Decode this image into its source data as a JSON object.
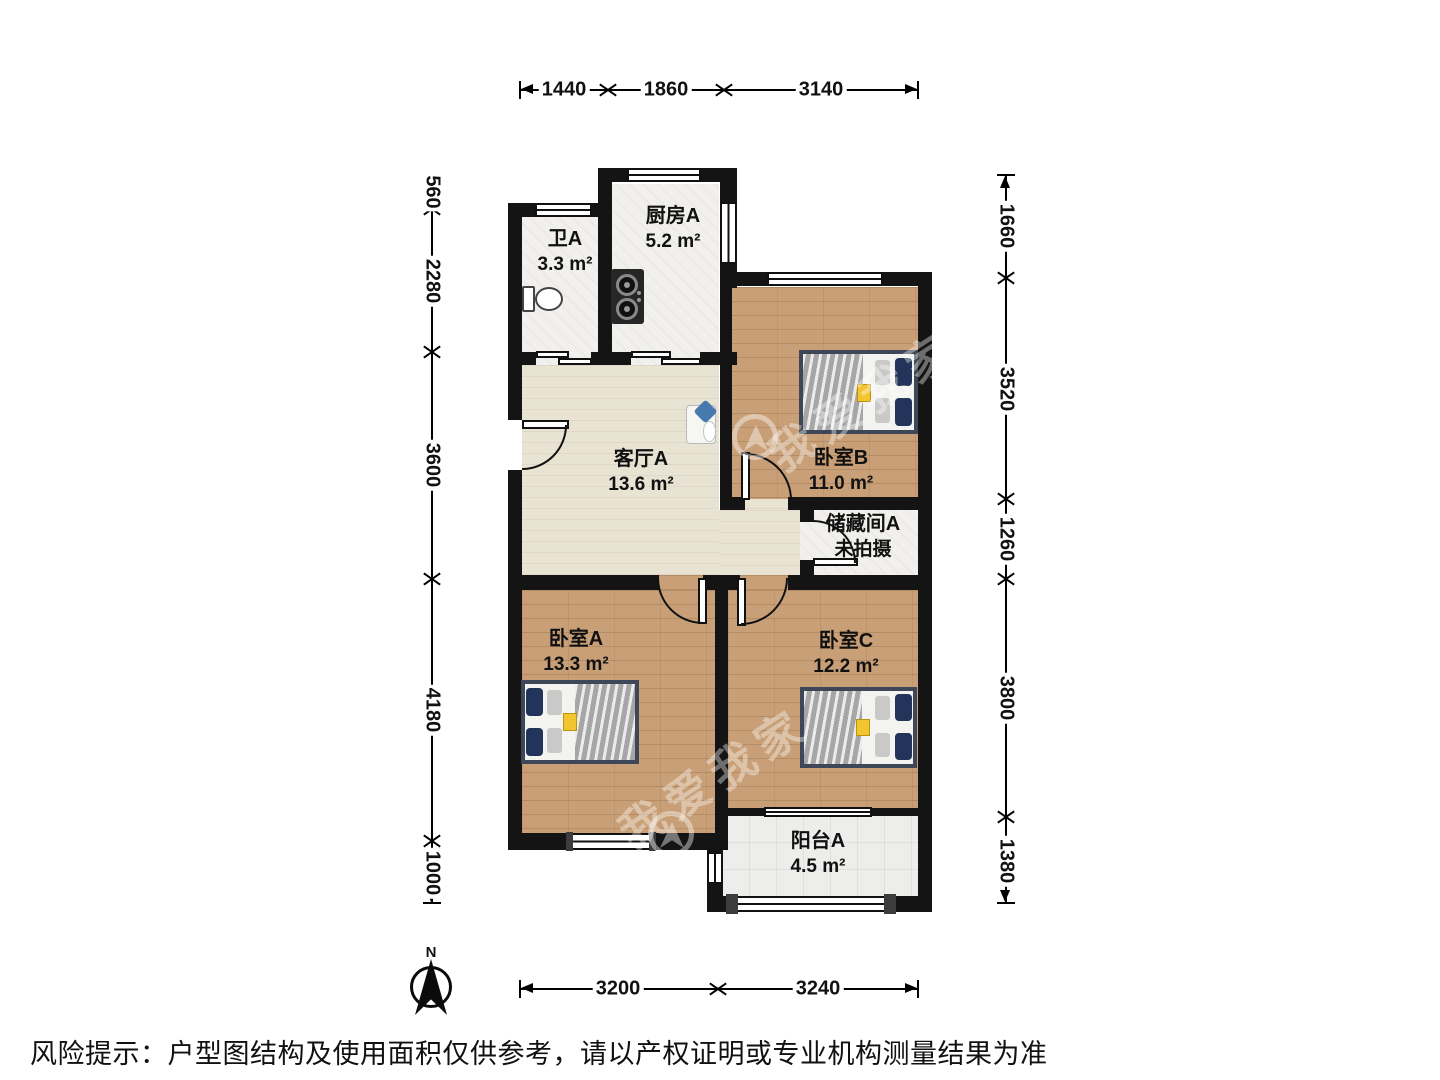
{
  "page": {
    "risk_notice": "风险提示：户型图结构及使用面积仅供参考，请以产权证明或专业机构测量结果为准"
  },
  "compass": {
    "label": "N"
  },
  "watermark": {
    "text": "我爱我家"
  },
  "dimensions": {
    "top": [
      "1440",
      "1860",
      "3140"
    ],
    "bottom": [
      "3200",
      "3240"
    ],
    "left": [
      "560",
      "2280",
      "3600",
      "4180",
      "1000"
    ],
    "right": [
      "1660",
      "3520",
      "1260",
      "3800",
      "1380"
    ]
  },
  "rooms": [
    {
      "name": "卫A",
      "area": "3.3 m²"
    },
    {
      "name": "厨房A",
      "area": "5.2 m²"
    },
    {
      "name": "客厅A",
      "area": "13.6 m²"
    },
    {
      "name": "卧室B",
      "area": "11.0 m²"
    },
    {
      "name": "储藏间A",
      "area": "未拍摄"
    },
    {
      "name": "卧室A",
      "area": "13.3 m²"
    },
    {
      "name": "卧室C",
      "area": "12.2 m²"
    },
    {
      "name": "阳台A",
      "area": "4.5 m²"
    }
  ],
  "colors": {
    "wall": "#141414",
    "wood_floor": "#c89f76",
    "living_floor": "#e9e3d3",
    "tile_floor": "#f1f0ec",
    "balcony_floor": "#ededeb",
    "bed_frame": "#3e4757",
    "bed_pillow": "#22345a",
    "sofa_pillow": "#4679ad",
    "accent_item": "#f2c42d"
  }
}
